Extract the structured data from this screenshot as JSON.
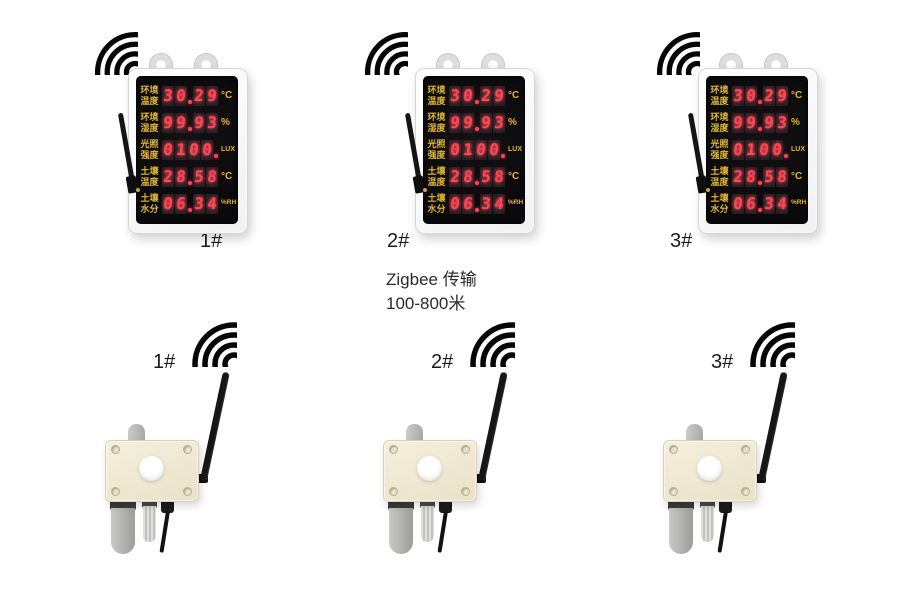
{
  "note": {
    "line1": "Zigbee 传输",
    "line2": "100-800米"
  },
  "display_units": [
    {
      "label": "1#"
    },
    {
      "label": "2#"
    },
    {
      "label": "3#"
    }
  ],
  "sensor_units": [
    {
      "label": "1#"
    },
    {
      "label": "2#"
    },
    {
      "label": "3#"
    }
  ],
  "screen": {
    "rows": [
      {
        "label_line1": "环境",
        "label_line2": "温度",
        "value": "30.29",
        "unit": "°C"
      },
      {
        "label_line1": "环境",
        "label_line2": "湿度",
        "value": "99.93",
        "unit": "%"
      },
      {
        "label_line1": "光照",
        "label_line2": "强度",
        "value": "0100.",
        "unit": "LUX"
      },
      {
        "label_line1": "土壤",
        "label_line2": "温度",
        "value": "28.58",
        "unit": "°C"
      },
      {
        "label_line1": "土壤",
        "label_line2": "水分",
        "value": "06.34",
        "unit": "%RH"
      }
    ]
  },
  "icons": {
    "wifi": "wifi-signal-arcs"
  },
  "colors": {
    "label_yellow": "#e3b92f",
    "digit_red": "#ff4653",
    "screen_black": "#0c0b0d",
    "box_cream": "#efe8d4",
    "antenna_black": "#161616"
  }
}
